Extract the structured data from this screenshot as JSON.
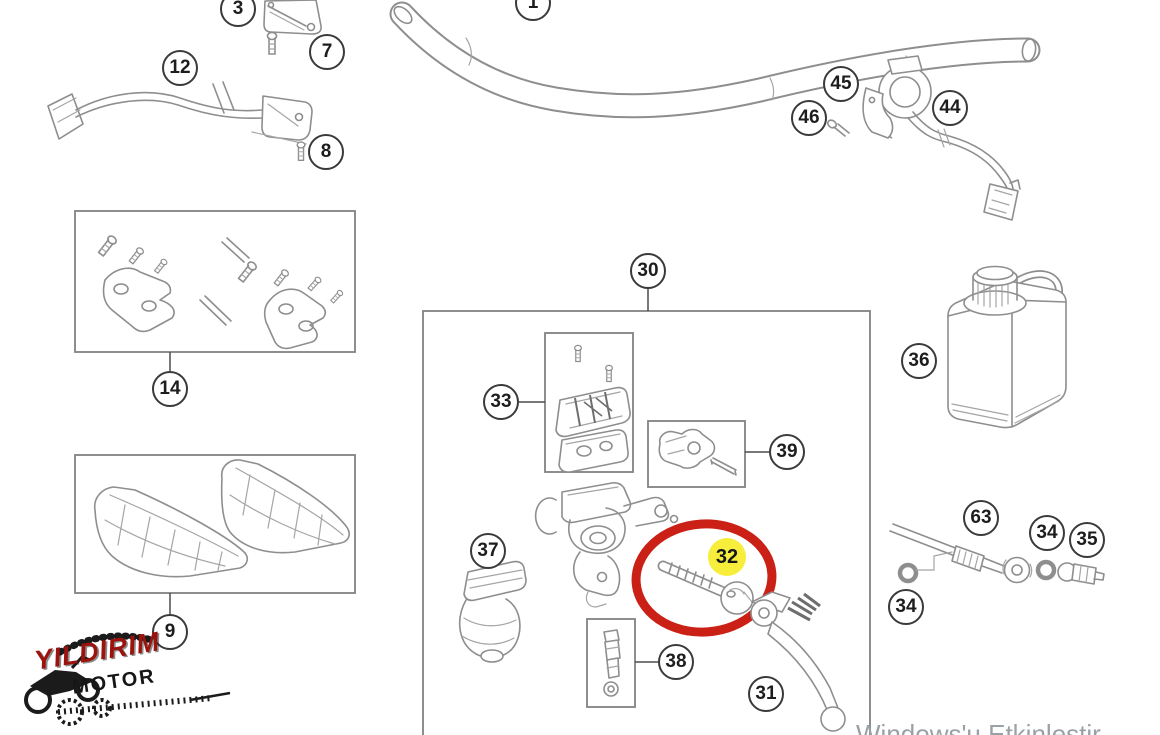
{
  "diagram": {
    "type": "parts-diagram",
    "subject": "handlebar-and-brake-control-exploded-view",
    "line_color": "#8e8e8e",
    "callouts": {
      "c1": {
        "label": "1"
      },
      "c3": {
        "label": "3"
      },
      "c7": {
        "label": "7"
      },
      "c8": {
        "label": "8"
      },
      "c12": {
        "label": "12"
      },
      "c14": {
        "label": "14"
      },
      "c9": {
        "label": "9"
      },
      "c30": {
        "label": "30"
      },
      "c33": {
        "label": "33"
      },
      "c39": {
        "label": "39"
      },
      "c36": {
        "label": "36"
      },
      "c37": {
        "label": "37"
      },
      "c32": {
        "label": "32"
      },
      "c38": {
        "label": "38"
      },
      "c31": {
        "label": "31"
      },
      "c44": {
        "label": "44"
      },
      "c45": {
        "label": "45"
      },
      "c46": {
        "label": "46"
      },
      "c63": {
        "label": "63"
      },
      "c34a": {
        "label": "34"
      },
      "c34b": {
        "label": "34"
      },
      "c35": {
        "label": "35"
      }
    },
    "highlight": {
      "part": "32",
      "ring_color": "#cb2015",
      "badge_color": "#f6ee3a"
    }
  },
  "logo": {
    "line1": "YILDIRIM",
    "line2": "MOTOR",
    "accent_color": "#9c120c"
  },
  "watermark": {
    "text": "Windows'u Etkinleştir",
    "color": "#99a1a7"
  }
}
